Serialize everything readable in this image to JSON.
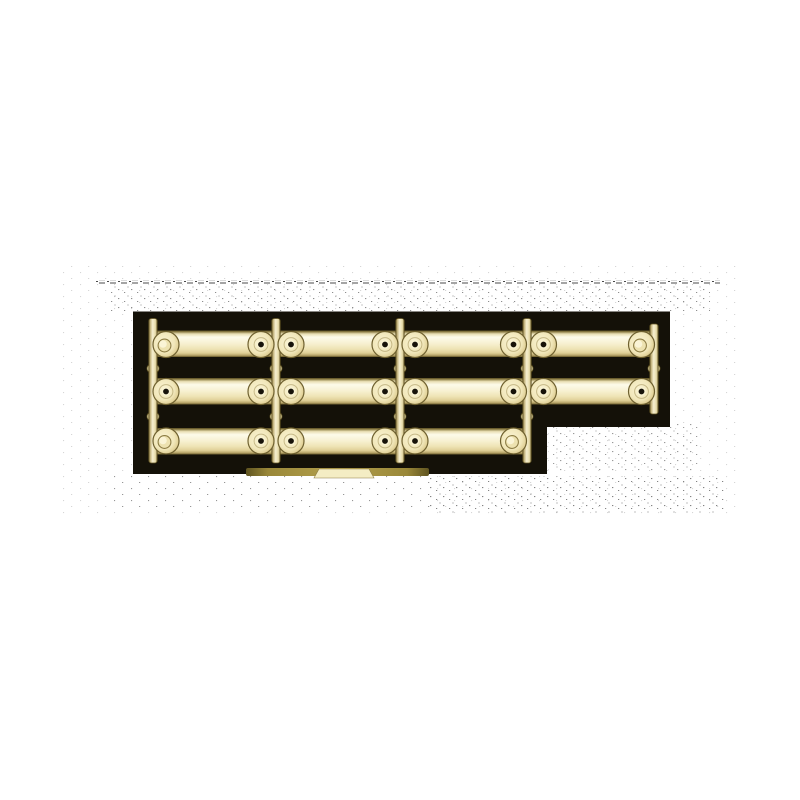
{
  "scene": {
    "description": "Product photograph of a gold/brass-coloured plastic sprue of miniature bar parts (handles/rails) on a black backdrop, centered on a white page",
    "canvas": {
      "width": 800,
      "height": 800,
      "background": "#ffffff"
    },
    "backdrop": {
      "color": "#141108",
      "polygon": [
        [
          133,
          311.5
        ],
        [
          670,
          311.5
        ],
        [
          670,
          427
        ],
        [
          547,
          427
        ],
        [
          547,
          474
        ],
        [
          133,
          474
        ]
      ]
    },
    "parts_per_row": [
      4,
      4,
      3
    ],
    "palette": {
      "hole": "#17130a",
      "speckle": "#1e1e1e",
      "pad_stroke": "#6f6130",
      "washer_stroke": "#a6965e",
      "boss_fill": "#ede2b0",
      "boss_stroke": "#8d7d45",
      "boss_highlight": "#faf4d6",
      "bright_ring": "#f9f3d2",
      "runner_stroke": "#5f5222",
      "tag_cream": "#f4edc4",
      "gradients": {
        "bar": {
          "type": "linear",
          "x1": 0,
          "y1": 0,
          "x2": 0,
          "y2": 1,
          "stops": [
            [
              0,
              "#574b20"
            ],
            [
              0.05,
              "#8f8049"
            ],
            [
              0.13,
              "#e9dfb4"
            ],
            [
              0.25,
              "#fdfbea"
            ],
            [
              0.5,
              "#f7f0d0"
            ],
            [
              0.7,
              "#eee3b4"
            ],
            [
              0.85,
              "#dfcf96"
            ],
            [
              0.94,
              "#b5a266"
            ],
            [
              1,
              "#615426"
            ]
          ]
        },
        "runner": {
          "type": "linear",
          "x1": 0,
          "y1": 0,
          "x2": 1,
          "y2": 0,
          "stops": [
            [
              0,
              "#6a5c2b"
            ],
            [
              0.18,
              "#c3b37c"
            ],
            [
              0.45,
              "#f6efd0"
            ],
            [
              0.8,
              "#e6dba8"
            ],
            [
              1,
              "#6a5c2b"
            ]
          ]
        },
        "pad": {
          "type": "radial",
          "stops": [
            [
              0,
              "#faf4d4"
            ],
            [
              0.65,
              "#f1e7ba"
            ],
            [
              0.9,
              "#e2d299"
            ],
            [
              1,
              "#cdbb7e"
            ]
          ]
        },
        "tag": {
          "type": "linear",
          "x1": 0,
          "y1": 0,
          "x2": 1,
          "y2": 0,
          "stops": [
            [
              0,
              "#5f5420"
            ],
            [
              0.12,
              "#9a8839"
            ],
            [
              0.5,
              "#b3a04c"
            ],
            [
              0.88,
              "#9a8839"
            ],
            [
              1,
              "#5f5420"
            ]
          ]
        }
      }
    },
    "bars": [
      {
        "x": 150,
        "y": 330.5,
        "w": 503,
        "h": 26.5
      },
      {
        "x": 150,
        "y": 378,
        "w": 503,
        "h": 26.5
      },
      {
        "x": 150,
        "y": 428,
        "w": 381,
        "h": 26.5
      }
    ],
    "runner_width": 8.5,
    "runners": [
      {
        "x": 153,
        "y1": 318.5,
        "y2": 463
      },
      {
        "x": 276,
        "y1": 318.5,
        "y2": 463
      },
      {
        "x": 400,
        "y1": 318.5,
        "y2": 463
      },
      {
        "x": 527,
        "y1": 318.5,
        "y2": 463
      },
      {
        "x": 654,
        "y1": 324,
        "y2": 414
      }
    ],
    "runner_nodes": [
      [
        153,
        368.5
      ],
      [
        153,
        416.5
      ],
      [
        276,
        368.5
      ],
      [
        276,
        416.5
      ],
      [
        400,
        368.5
      ],
      [
        400,
        416.5
      ],
      [
        527,
        368.5
      ],
      [
        527,
        416.5
      ],
      [
        654,
        368.5
      ]
    ],
    "pad_radius": 13,
    "pad_rows": [
      {
        "cy": 344.5,
        "pads": [
          [
            166,
            "boss"
          ],
          [
            261,
            "hole"
          ],
          [
            291,
            "hole"
          ],
          [
            385,
            "hole"
          ],
          [
            415,
            "hole"
          ],
          [
            513.5,
            "hole"
          ],
          [
            543.5,
            "hole"
          ],
          [
            641.5,
            "boss"
          ]
        ]
      },
      {
        "cy": 391.5,
        "pads": [
          [
            166,
            "hole"
          ],
          [
            261,
            "hole"
          ],
          [
            291,
            "hole"
          ],
          [
            385,
            "hole"
          ],
          [
            415,
            "hole"
          ],
          [
            513.5,
            "hole"
          ],
          [
            543.5,
            "hole"
          ],
          [
            641.5,
            "hole"
          ]
        ]
      },
      {
        "cy": 441,
        "pads": [
          [
            166,
            "boss"
          ],
          [
            261,
            "hole"
          ],
          [
            291,
            "hole"
          ],
          [
            385,
            "hole"
          ],
          [
            415,
            "hole"
          ],
          [
            513.5,
            "boss"
          ]
        ]
      }
    ],
    "bottom_tag": {
      "band": {
        "x": 246,
        "y": 468,
        "w": 183,
        "h": 8
      },
      "center_points": [
        [
          319,
          469
        ],
        [
          369,
          469
        ],
        [
          374,
          478
        ],
        [
          314,
          478
        ]
      ]
    },
    "speckle_areas": [
      {
        "x": 95,
        "y": 280.5,
        "w": 625,
        "h": 3,
        "pattern": "dash",
        "opacity": 0.8
      },
      {
        "x": 110,
        "y": 284,
        "w": 600,
        "h": 27,
        "pattern": "A",
        "opacity": 0.5
      },
      {
        "x": 60,
        "y": 262,
        "w": 680,
        "h": 255,
        "pattern": "B",
        "opacity": 0.18
      },
      {
        "x": 548,
        "y": 424,
        "w": 150,
        "h": 48,
        "pattern": "A",
        "opacity": 0.45
      },
      {
        "x": 430,
        "y": 476,
        "w": 295,
        "h": 38,
        "pattern": "A",
        "opacity": 0.55
      },
      {
        "x": 110,
        "y": 476,
        "w": 320,
        "h": 32,
        "pattern": "B",
        "opacity": 0.35
      }
    ]
  }
}
